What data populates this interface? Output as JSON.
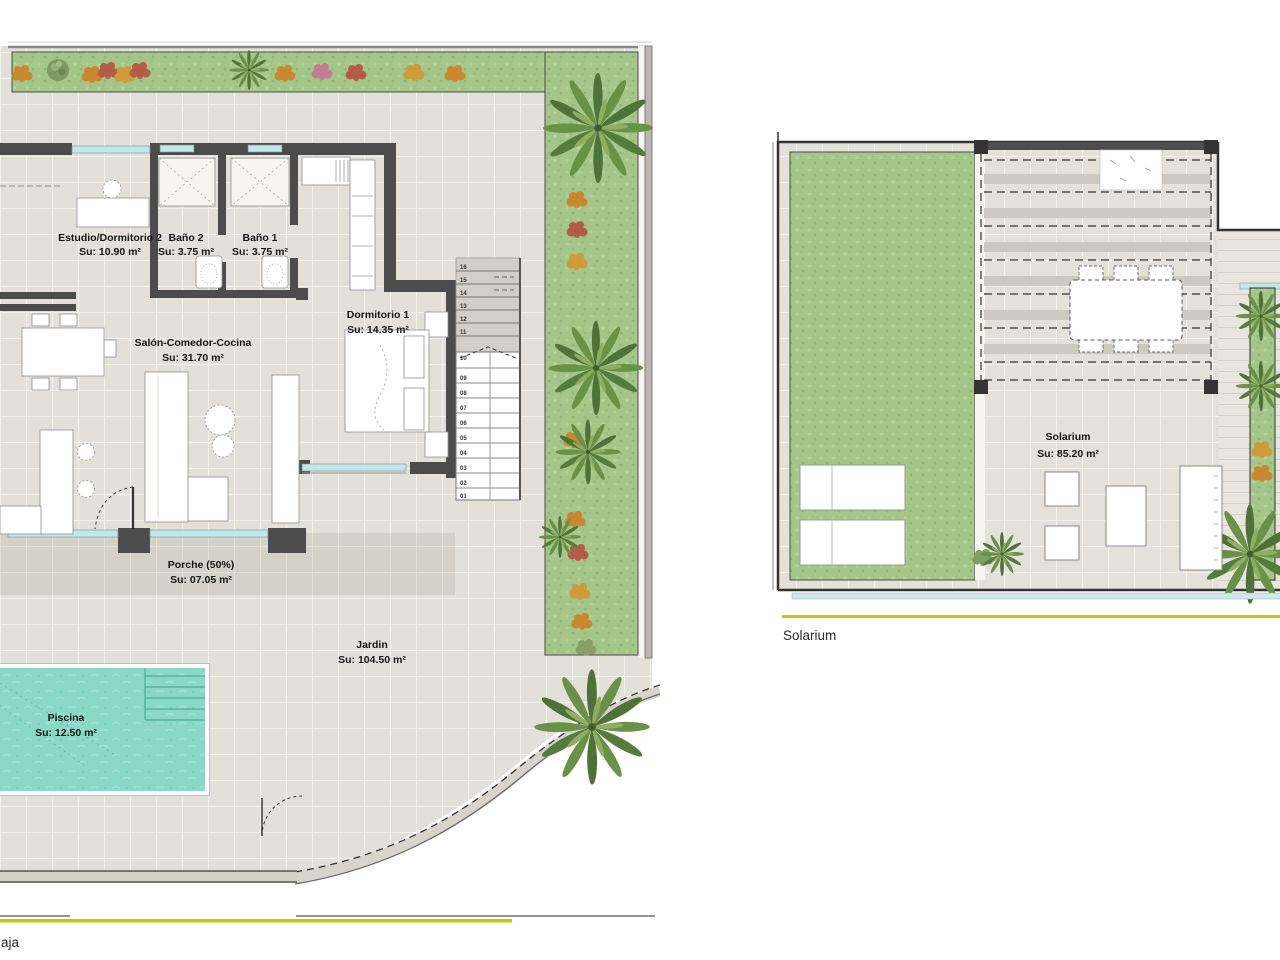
{
  "ground_floor": {
    "title": "aja",
    "rooms": [
      {
        "name": "Estudio/Dormitorio 2",
        "area": "Su: 10.90 m²"
      },
      {
        "name": "Baño 2",
        "area": "Su: 3.75 m²"
      },
      {
        "name": "Baño 1",
        "area": "Su: 3.75 m²"
      },
      {
        "name": "Salón-Comedor-Cocina",
        "area": "Su: 31.70 m²"
      },
      {
        "name": "Dormitorio 1",
        "area": "Su: 14.35 m²"
      },
      {
        "name": "Porche (50%)",
        "area": "Su: 07.05 m²"
      },
      {
        "name": "Jardin",
        "area": "Su: 104.50 m²"
      },
      {
        "name": "Piscina",
        "area": "Su: 12.50 m²"
      }
    ],
    "stairs": {
      "steps": [
        "16",
        "15",
        "14",
        "13",
        "12",
        "11",
        "10",
        "09",
        "08",
        "07",
        "06",
        "05",
        "04",
        "03",
        "02",
        "01"
      ]
    }
  },
  "solarium_floor": {
    "title": "Solarium",
    "rooms": [
      {
        "name": "Solarium",
        "area": "Su: 85.20 m²"
      }
    ]
  },
  "colors": {
    "accent": "#b8cf00",
    "pool": "#8ad8c8",
    "grass": "#a5c689",
    "tile": "#e3e0d9",
    "wall": "#4c4c4c",
    "window": "#bfe9e8"
  }
}
